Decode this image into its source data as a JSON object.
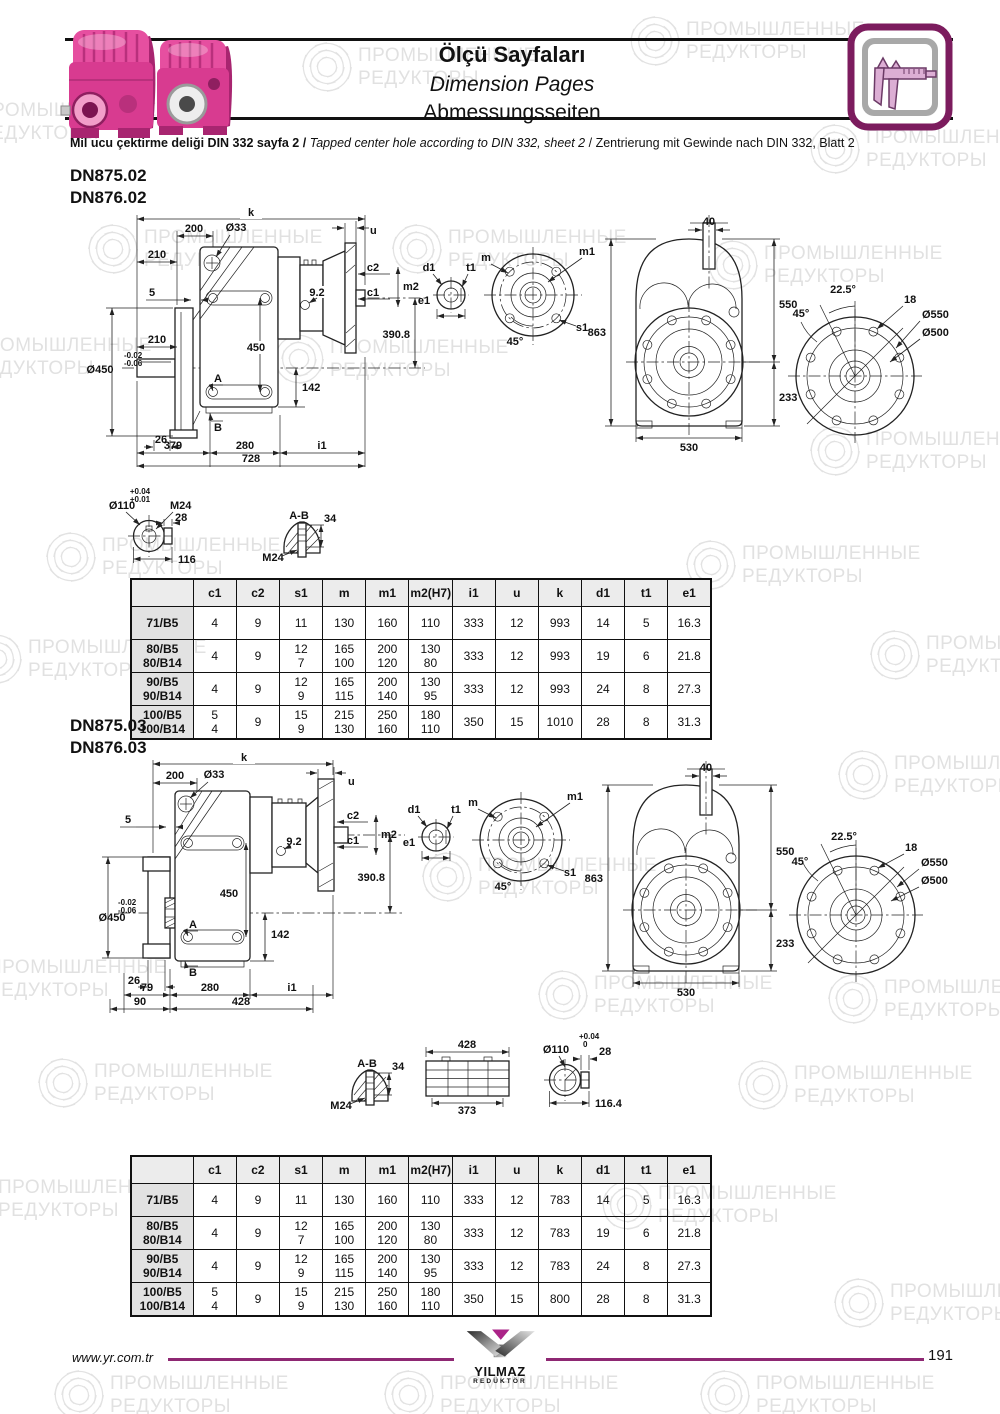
{
  "header": {
    "title_tr": "Ölçü Sayfaları",
    "title_en": "Dimension Pages",
    "title_de": "Abmessungsseiten",
    "note_tr": "Mil ucu çektirme deliği DIN 332 sayfa 2",
    "note_sep": "/",
    "note_en": "Tapped center hole according to DIN 332, sheet 2",
    "note_de": "Zentrierung mit Gewinde nach DIN 332, Blatt 2"
  },
  "watermark": {
    "line1": "ПРОМЫШЛЕННЫЕ",
    "line2": "РЕДУКТОРЫ"
  },
  "colors": {
    "accent": "#8e2873",
    "product_pink": "#d83b90",
    "ink": "#111111"
  },
  "sections": [
    {
      "model1": "DN875.02",
      "model2": "DN876.02",
      "side": {
        "k": "k",
        "w200": "200",
        "dia33": "Ø33",
        "u": "u",
        "t210": "210",
        "f5": "5",
        "m210": "210",
        "c2": "c2",
        "m2": "m2",
        "c1": "c1",
        "n92": "9.2",
        "h450": "450",
        "v3908": "390.8",
        "tol_a": "-0.02",
        "tol_b": "-0.06",
        "dia450": "Ø450",
        "pA": "A",
        "h142": "142",
        "pB": "B",
        "d26": "26",
        "d379": "379",
        "d280": "280",
        "i1": "i1",
        "d728": "728"
      },
      "shaft": {
        "d1": "d1",
        "t1": "t1",
        "e1": "e1"
      },
      "flange": {
        "m": "m",
        "m1": "m1",
        "s1": "s1",
        "a45": "45°"
      },
      "front": {
        "d40": "40",
        "d550": "550",
        "d233": "233",
        "d863": "863",
        "d530": "530"
      },
      "rear": {
        "a225": "22.5°",
        "a45": "45°",
        "d18": "18",
        "dia550": "Ø550",
        "dia500": "Ø500"
      },
      "detail_shaft": {
        "tol_a": "+0.04",
        "tol_b": "+0.01",
        "dia110": "Ø110",
        "m24": "M24",
        "d28": "28",
        "d116": "116"
      },
      "detail_ab": {
        "ab": "A-B",
        "d34": "34",
        "m24": "M24"
      },
      "table": {
        "headers": [
          "",
          "c1",
          "c2",
          "s1",
          "m",
          "m1",
          "m2(H7)",
          "i1",
          "u",
          "k",
          "d1",
          "t1",
          "e1"
        ],
        "rows": [
          [
            "71/B5",
            "4",
            "9",
            "11",
            "130",
            "160",
            "110",
            "333",
            "12",
            "993",
            "14",
            "5",
            "16.3"
          ],
          [
            "80/B5\n80/B14",
            "4",
            "9",
            "12\n7",
            "165\n100",
            "200\n120",
            "130\n80",
            "333",
            "12",
            "993",
            "19",
            "6",
            "21.8"
          ],
          [
            "90/B5\n90/B14",
            "4",
            "9",
            "12\n9",
            "165\n115",
            "200\n140",
            "130\n95",
            "333",
            "12",
            "993",
            "24",
            "8",
            "27.3"
          ],
          [
            "100/B5\n100/B14",
            "5\n4",
            "9",
            "15\n9",
            "215\n130",
            "250\n160",
            "180\n110",
            "350",
            "15",
            "1010",
            "28",
            "8",
            "31.3"
          ]
        ]
      }
    },
    {
      "model1": "DN875.03",
      "model2": "DN876.03",
      "side": {
        "k": "k",
        "w200": "200",
        "dia33": "Ø33",
        "u": "u",
        "f5": "5",
        "c2": "c2",
        "m2": "m2",
        "c1": "c1",
        "n92": "9.2",
        "h450": "450",
        "v3908": "390.8",
        "tol_a": "-0.02",
        "tol_b": "-0.06",
        "dia450": "Ø450",
        "pA": "A",
        "h142": "142",
        "pB": "B",
        "d26": "26",
        "d79": "79",
        "d280": "280",
        "i1": "i1",
        "d90": "90",
        "d428": "428"
      },
      "shaft": {
        "d1": "d1",
        "t1": "t1",
        "e1": "e1"
      },
      "flange": {
        "m": "m",
        "m1": "m1",
        "s1": "s1",
        "a45": "45°"
      },
      "front": {
        "d40": "40",
        "d550": "550",
        "d233": "233",
        "d863": "863",
        "d530": "530"
      },
      "rear": {
        "a225": "22.5°",
        "a45": "45°",
        "d18": "18",
        "dia550": "Ø550",
        "dia500": "Ø500"
      },
      "detail_ab": {
        "ab": "A-B",
        "d34": "34",
        "m24": "M24"
      },
      "detail_sleeve": {
        "d428": "428",
        "d373": "373"
      },
      "detail_shaft": {
        "tol_a": "+0.04",
        "tol_b": "0",
        "dia110": "Ø110",
        "d28": "28",
        "d1164": "116.4"
      },
      "table": {
        "headers": [
          "",
          "c1",
          "c2",
          "s1",
          "m",
          "m1",
          "m2(H7)",
          "i1",
          "u",
          "k",
          "d1",
          "t1",
          "e1"
        ],
        "rows": [
          [
            "71/B5",
            "4",
            "9",
            "11",
            "130",
            "160",
            "110",
            "333",
            "12",
            "783",
            "14",
            "5",
            "16.3"
          ],
          [
            "80/B5\n80/B14",
            "4",
            "9",
            "12\n7",
            "165\n100",
            "200\n120",
            "130\n80",
            "333",
            "12",
            "783",
            "19",
            "6",
            "21.8"
          ],
          [
            "90/B5\n90/B14",
            "4",
            "9",
            "12\n9",
            "165\n115",
            "200\n140",
            "130\n95",
            "333",
            "12",
            "783",
            "24",
            "8",
            "27.3"
          ],
          [
            "100/B5\n100/B14",
            "5\n4",
            "9",
            "15\n9",
            "215\n130",
            "250\n160",
            "180\n110",
            "350",
            "15",
            "800",
            "28",
            "8",
            "31.3"
          ]
        ]
      }
    }
  ],
  "footer": {
    "url": "www.yr.com.tr",
    "logo_top": "YILMAZ",
    "logo_bottom": "REDÜKTÖR",
    "page": "191"
  }
}
